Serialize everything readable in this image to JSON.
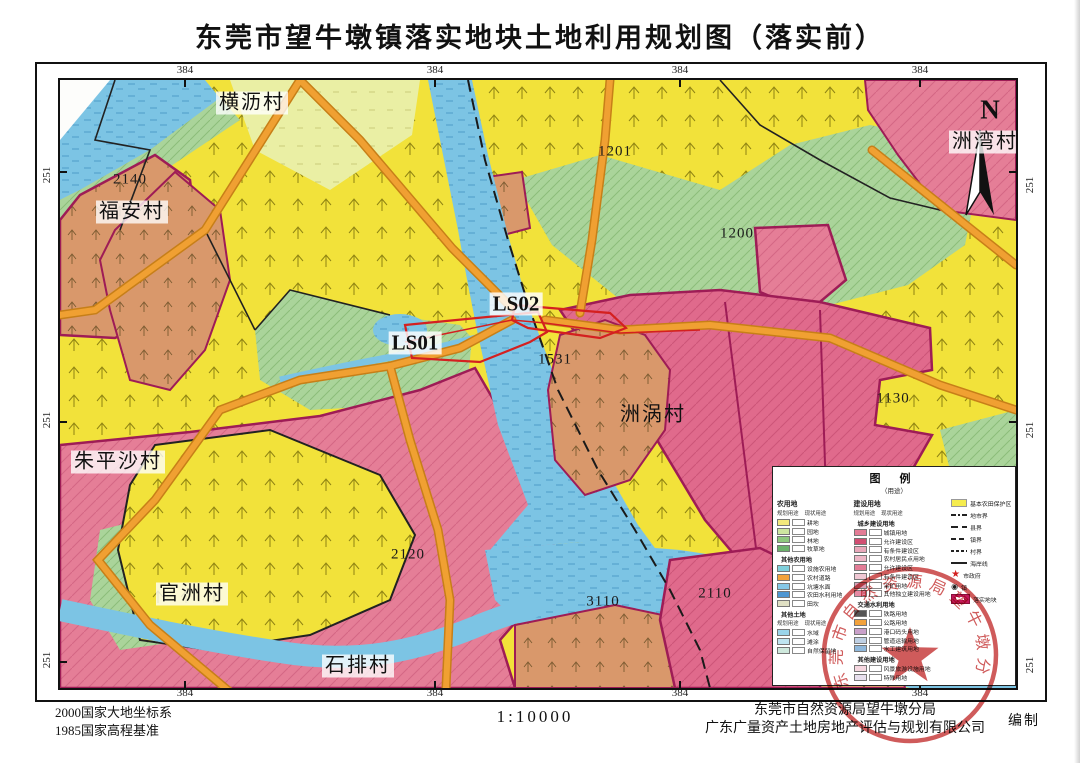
{
  "page": {
    "title": "东莞市望牛墩镇落实地块土地利用规划图（落实前）"
  },
  "footer": {
    "datum1": "2000国家大地坐标系",
    "datum2": "1985国家高程基准",
    "scale": "1:10000",
    "agency1": "东莞市自然资源局望牛墩分局",
    "agency2": "广东广量资产土地房地产评估与规划有限公司",
    "compiled": "编制"
  },
  "stamp": {
    "text": "东莞市自然资源局望牛墩分局"
  },
  "map": {
    "north": "N",
    "coord_top": [
      "384",
      "384",
      "384",
      "384"
    ],
    "coord_bottom": [
      "384",
      "384",
      "384",
      "384"
    ],
    "coord_left": [
      "251",
      "251",
      "251"
    ],
    "coord_right": [
      "251",
      "251",
      "251"
    ],
    "villages": {
      "hengli": "横沥村",
      "fuan": "福安村",
      "zhupingsha": "朱平沙村",
      "guanzhou": "官洲村",
      "shipai": "石排村",
      "zhouwan": "洲湾村",
      "zhouwo": "洲涡村"
    },
    "plots": {
      "p2140": "2140",
      "p1201": "1201",
      "p1200": "1200",
      "p1531": "1531",
      "p1130": "1130",
      "p2120": "2120",
      "p3110": "3110",
      "p2110": "2110"
    },
    "sites": {
      "ls01": "LS01",
      "ls02": "LS02"
    }
  },
  "legend": {
    "title": "图 例",
    "subtitle": "（用途）",
    "col1": {
      "header": "农用地",
      "sub1": "规划用途",
      "sub2": "现状用途",
      "g1": [
        {
          "label": "耕地",
          "c": "#f3e87c"
        },
        {
          "label": "园地",
          "c": "#cde6a0"
        },
        {
          "label": "林地",
          "c": "#8ec87e"
        },
        {
          "label": "牧草地",
          "c": "#6cb26c"
        }
      ],
      "g2_header": "其他农用地",
      "g2": [
        {
          "label": "设施农用地",
          "c": "#7fd0dc"
        },
        {
          "label": "农村道路",
          "c": "#f2a23c"
        },
        {
          "label": "坑塘水面",
          "c": "#86c8e8"
        },
        {
          "label": "农田水利用地",
          "c": "#4e96d2"
        },
        {
          "label": "田坎",
          "c": "#e0e0c4"
        }
      ],
      "g3_header": "其他土地",
      "g3_sub1": "规划用途",
      "g3_sub2": "现状用途",
      "g3": [
        {
          "label": "水域",
          "c": "#9ad4ea"
        },
        {
          "label": "滩涂",
          "c": "#bfe4f0"
        },
        {
          "label": "自然保留地",
          "c": "#cfe9dd"
        }
      ]
    },
    "col2": {
      "header": "建设用地",
      "sub1": "规划用途",
      "sub2": "现状用途",
      "g1_header": "城乡建设用地",
      "g1": [
        {
          "label": "城镇用地",
          "c": "#e37c96"
        },
        {
          "label": "允许建设区",
          "c": "#d14e72"
        },
        {
          "label": "有条件建设区",
          "c": "#e9a8ba"
        },
        {
          "label": "农村居民点用地",
          "c": "#edb6c6"
        },
        {
          "label": "允许建设区",
          "c": "#e37c96"
        },
        {
          "label": "有条件建设区",
          "c": "#f0c8d4"
        },
        {
          "label": "采矿用地",
          "c": "#d9a0b8"
        },
        {
          "label": "其他独立建设用地",
          "c": "#e58aa4"
        }
      ],
      "g2_header": "交通水利用地",
      "g2": [
        {
          "label": "铁路用地",
          "c": "#555555"
        },
        {
          "label": "公路用地",
          "c": "#f2a23c"
        },
        {
          "label": "港口码头用地",
          "c": "#c9a0c9"
        },
        {
          "label": "管道运输用地",
          "c": "#bfd0e4"
        },
        {
          "label": "水工建筑用地",
          "c": "#8fb8dc"
        }
      ],
      "g3_header": "其他建设用地",
      "g3": [
        {
          "label": "风景旅游设施用地",
          "c": "#f6d7e0"
        },
        {
          "label": "特殊用地",
          "c": "#e8e0ee"
        }
      ]
    },
    "col3": {
      "farmland_zone": "基本农田保护区",
      "city_boundary": "地市界",
      "county_boundary": "县界",
      "town_boundary": "镇界",
      "village_boundary": "村界",
      "coastline": "海岸线",
      "city_gov": "市政府",
      "town_gov": "镇",
      "plot": "落实地块"
    }
  },
  "colors": {
    "farmland_yellow": "#f2e23a",
    "orchard_green": "#aad49a",
    "construction_pink": "#e57e97",
    "residential_salmon": "#d9986b",
    "water_blue": "#7cc4e4",
    "road_orange": "#f0a032",
    "plot_red": "#d42020",
    "boundary_magenta": "#9e1c56",
    "stamp_red": "#c43030"
  }
}
